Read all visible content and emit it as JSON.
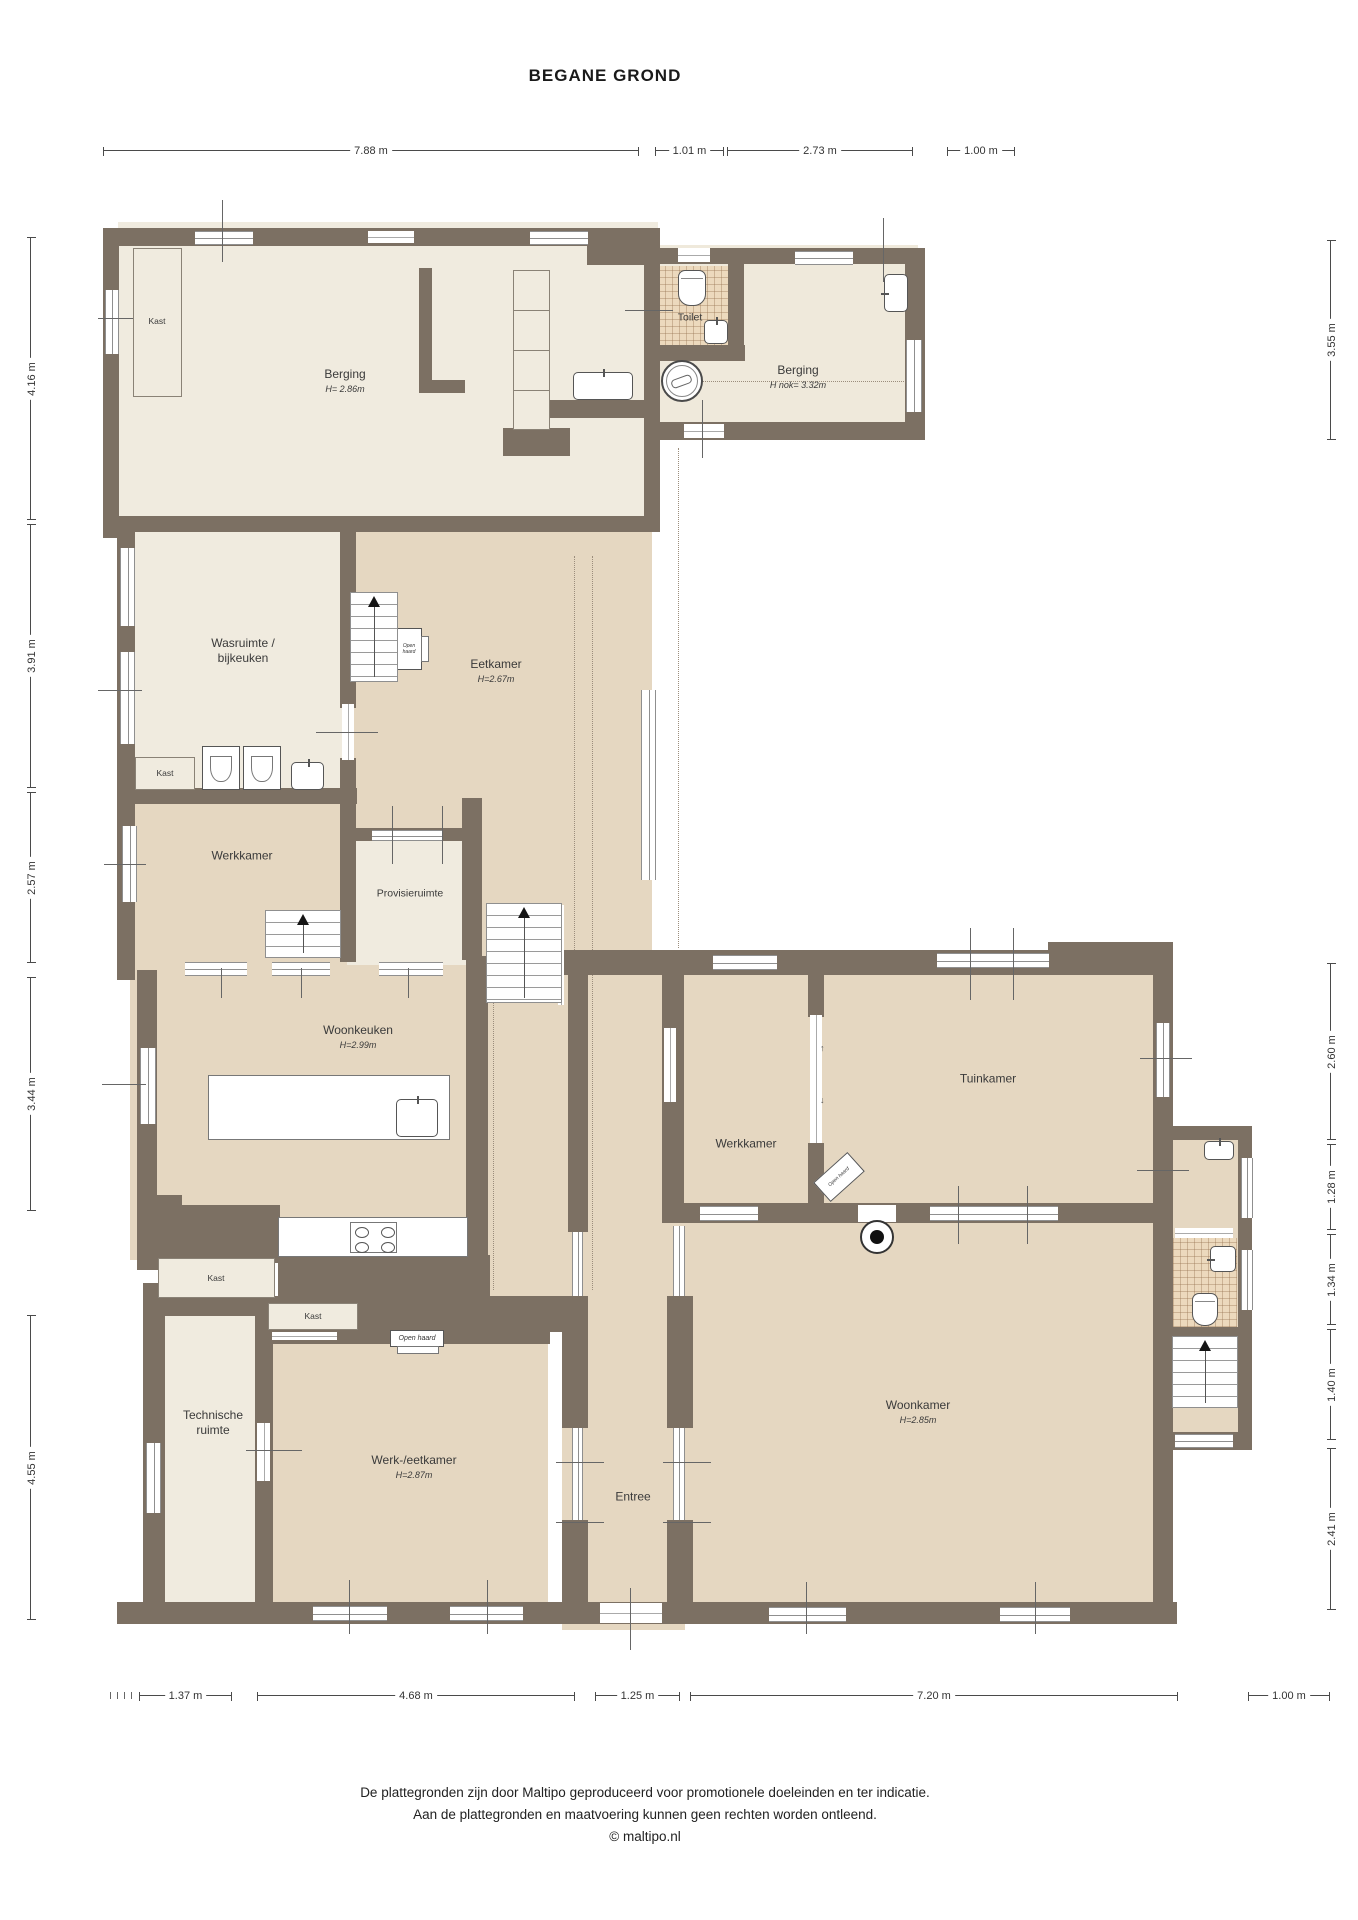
{
  "title": "BEGANE GROND",
  "colors": {
    "wall": "#7c7063",
    "floor_cream": "#f0ebdf",
    "floor_tan": "#e5d7c1",
    "floor_tile": "#ecd9bd",
    "window": "#8f8f8f",
    "dimension": "#4a4a4a"
  },
  "rooms": [
    {
      "id": "berging-1",
      "name": "Berging",
      "sub": "H= 2.86m"
    },
    {
      "id": "toilet",
      "name": "Toilet",
      "sub": ""
    },
    {
      "id": "berging-2",
      "name": "Berging",
      "sub": "H nok= 3.32m"
    },
    {
      "id": "wasruimte",
      "name": "Wasruimte /",
      "name2": "bijkeuken"
    },
    {
      "id": "eetkamer",
      "name": "Eetkamer",
      "sub": "H=2.67m"
    },
    {
      "id": "werkkamer-1",
      "name": "Werkkamer"
    },
    {
      "id": "provisieruimte",
      "name": "Provisieruimte"
    },
    {
      "id": "woonkeuken",
      "name": "Woonkeuken",
      "sub": "H=2.99m"
    },
    {
      "id": "werkkamer-2",
      "name": "Werkkamer"
    },
    {
      "id": "tuinkamer",
      "name": "Tuinkamer"
    },
    {
      "id": "technische-ruimte",
      "name": "Technische",
      "name2": "ruimte"
    },
    {
      "id": "werk-eetkamer",
      "name": "Werk-/eetkamer",
      "sub": "H=2.87m"
    },
    {
      "id": "entree",
      "name": "Entree"
    },
    {
      "id": "woonkamer",
      "name": "Woonkamer",
      "sub": "H=2.85m"
    }
  ],
  "closet_label": "Kast",
  "fireplace_label": "Open haard",
  "glyphs": {
    "arrow_up": "↑",
    "arrow_down": "↓"
  },
  "icons": {
    "toilet": "css-shape",
    "sink": "css-shape",
    "washing-machine": "css-shape",
    "well": "css-shape",
    "stove": "css-shape",
    "cooktop": "css-shape",
    "stairs-up": "css-shape",
    "fireplace": "css-shape",
    "shelves": "css-shape"
  },
  "dimensions": {
    "top": [
      "7.88 m",
      "1.01 m",
      "2.73 m",
      "1.00 m"
    ],
    "left": [
      "4.16 m",
      "3.91 m",
      "2.57 m",
      "3.44 m",
      "4.55 m"
    ],
    "right": [
      "3.55 m",
      "2.60 m",
      "1.28 m",
      "1.34 m",
      "1.40 m",
      "2.41 m"
    ],
    "bottom": [
      "1.37 m",
      "4.68 m",
      "1.25 m",
      "7.20 m",
      "1.00 m"
    ]
  },
  "footer": {
    "line1": "De plattegronden zijn door Maltipo geproduceerd voor promotionele doeleinden en ter indicatie.",
    "line2": "Aan de plattegronden en maatvoering kunnen geen rechten worden ontleend.",
    "line3": "© maltipo.nl"
  }
}
